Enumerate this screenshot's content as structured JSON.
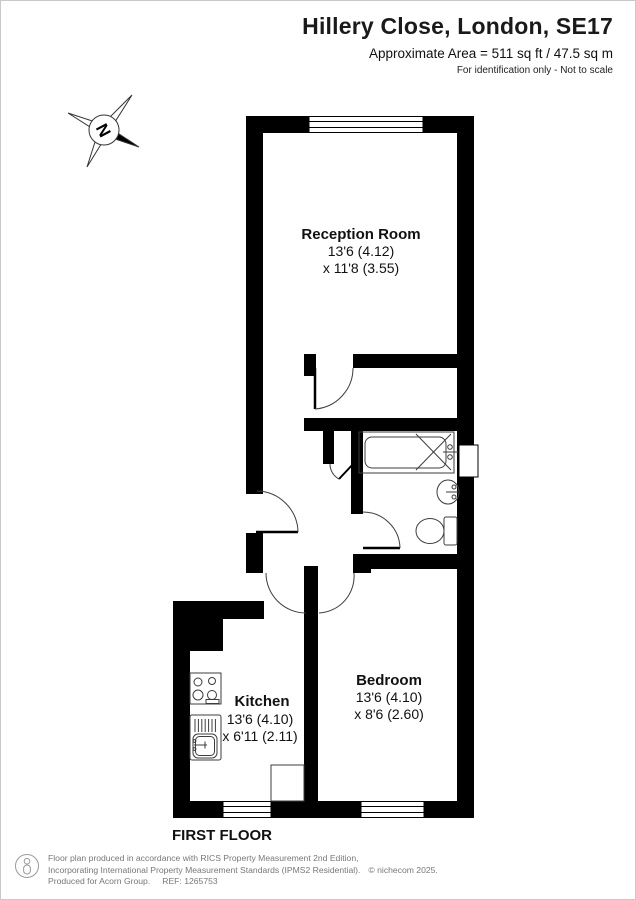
{
  "header": {
    "title": "Hillery Close, London, SE17",
    "area": "Approximate Area = 511 sq ft / 47.5 sq m",
    "disclaimer": "For identification only - Not to scale"
  },
  "compass": {
    "label": "N"
  },
  "floor_label": "FIRST FLOOR",
  "rooms": [
    {
      "name": "Reception Room",
      "dims1": "13'6 (4.12)",
      "dims2": "x 11'8 (3.55)"
    },
    {
      "name": "Kitchen",
      "dims1": "13'6 (4.10)",
      "dims2": "x 6'11 (2.11)"
    },
    {
      "name": "Bedroom",
      "dims1": "13'6 (4.10)",
      "dims2": "x 8'6 (2.60)"
    }
  ],
  "footer": {
    "line1": "Floor plan produced in accordance with RICS Property Measurement 2nd Edition,",
    "line2": "Incorporating International Property Measurement Standards (IPMS2 Residential).",
    "copyright": "© nichecom 2025.",
    "line3": "Produced for Acorn Group.",
    "ref": "REF: 1265753"
  },
  "colors": {
    "wall": "#000000",
    "line": "#3d3d3d"
  }
}
